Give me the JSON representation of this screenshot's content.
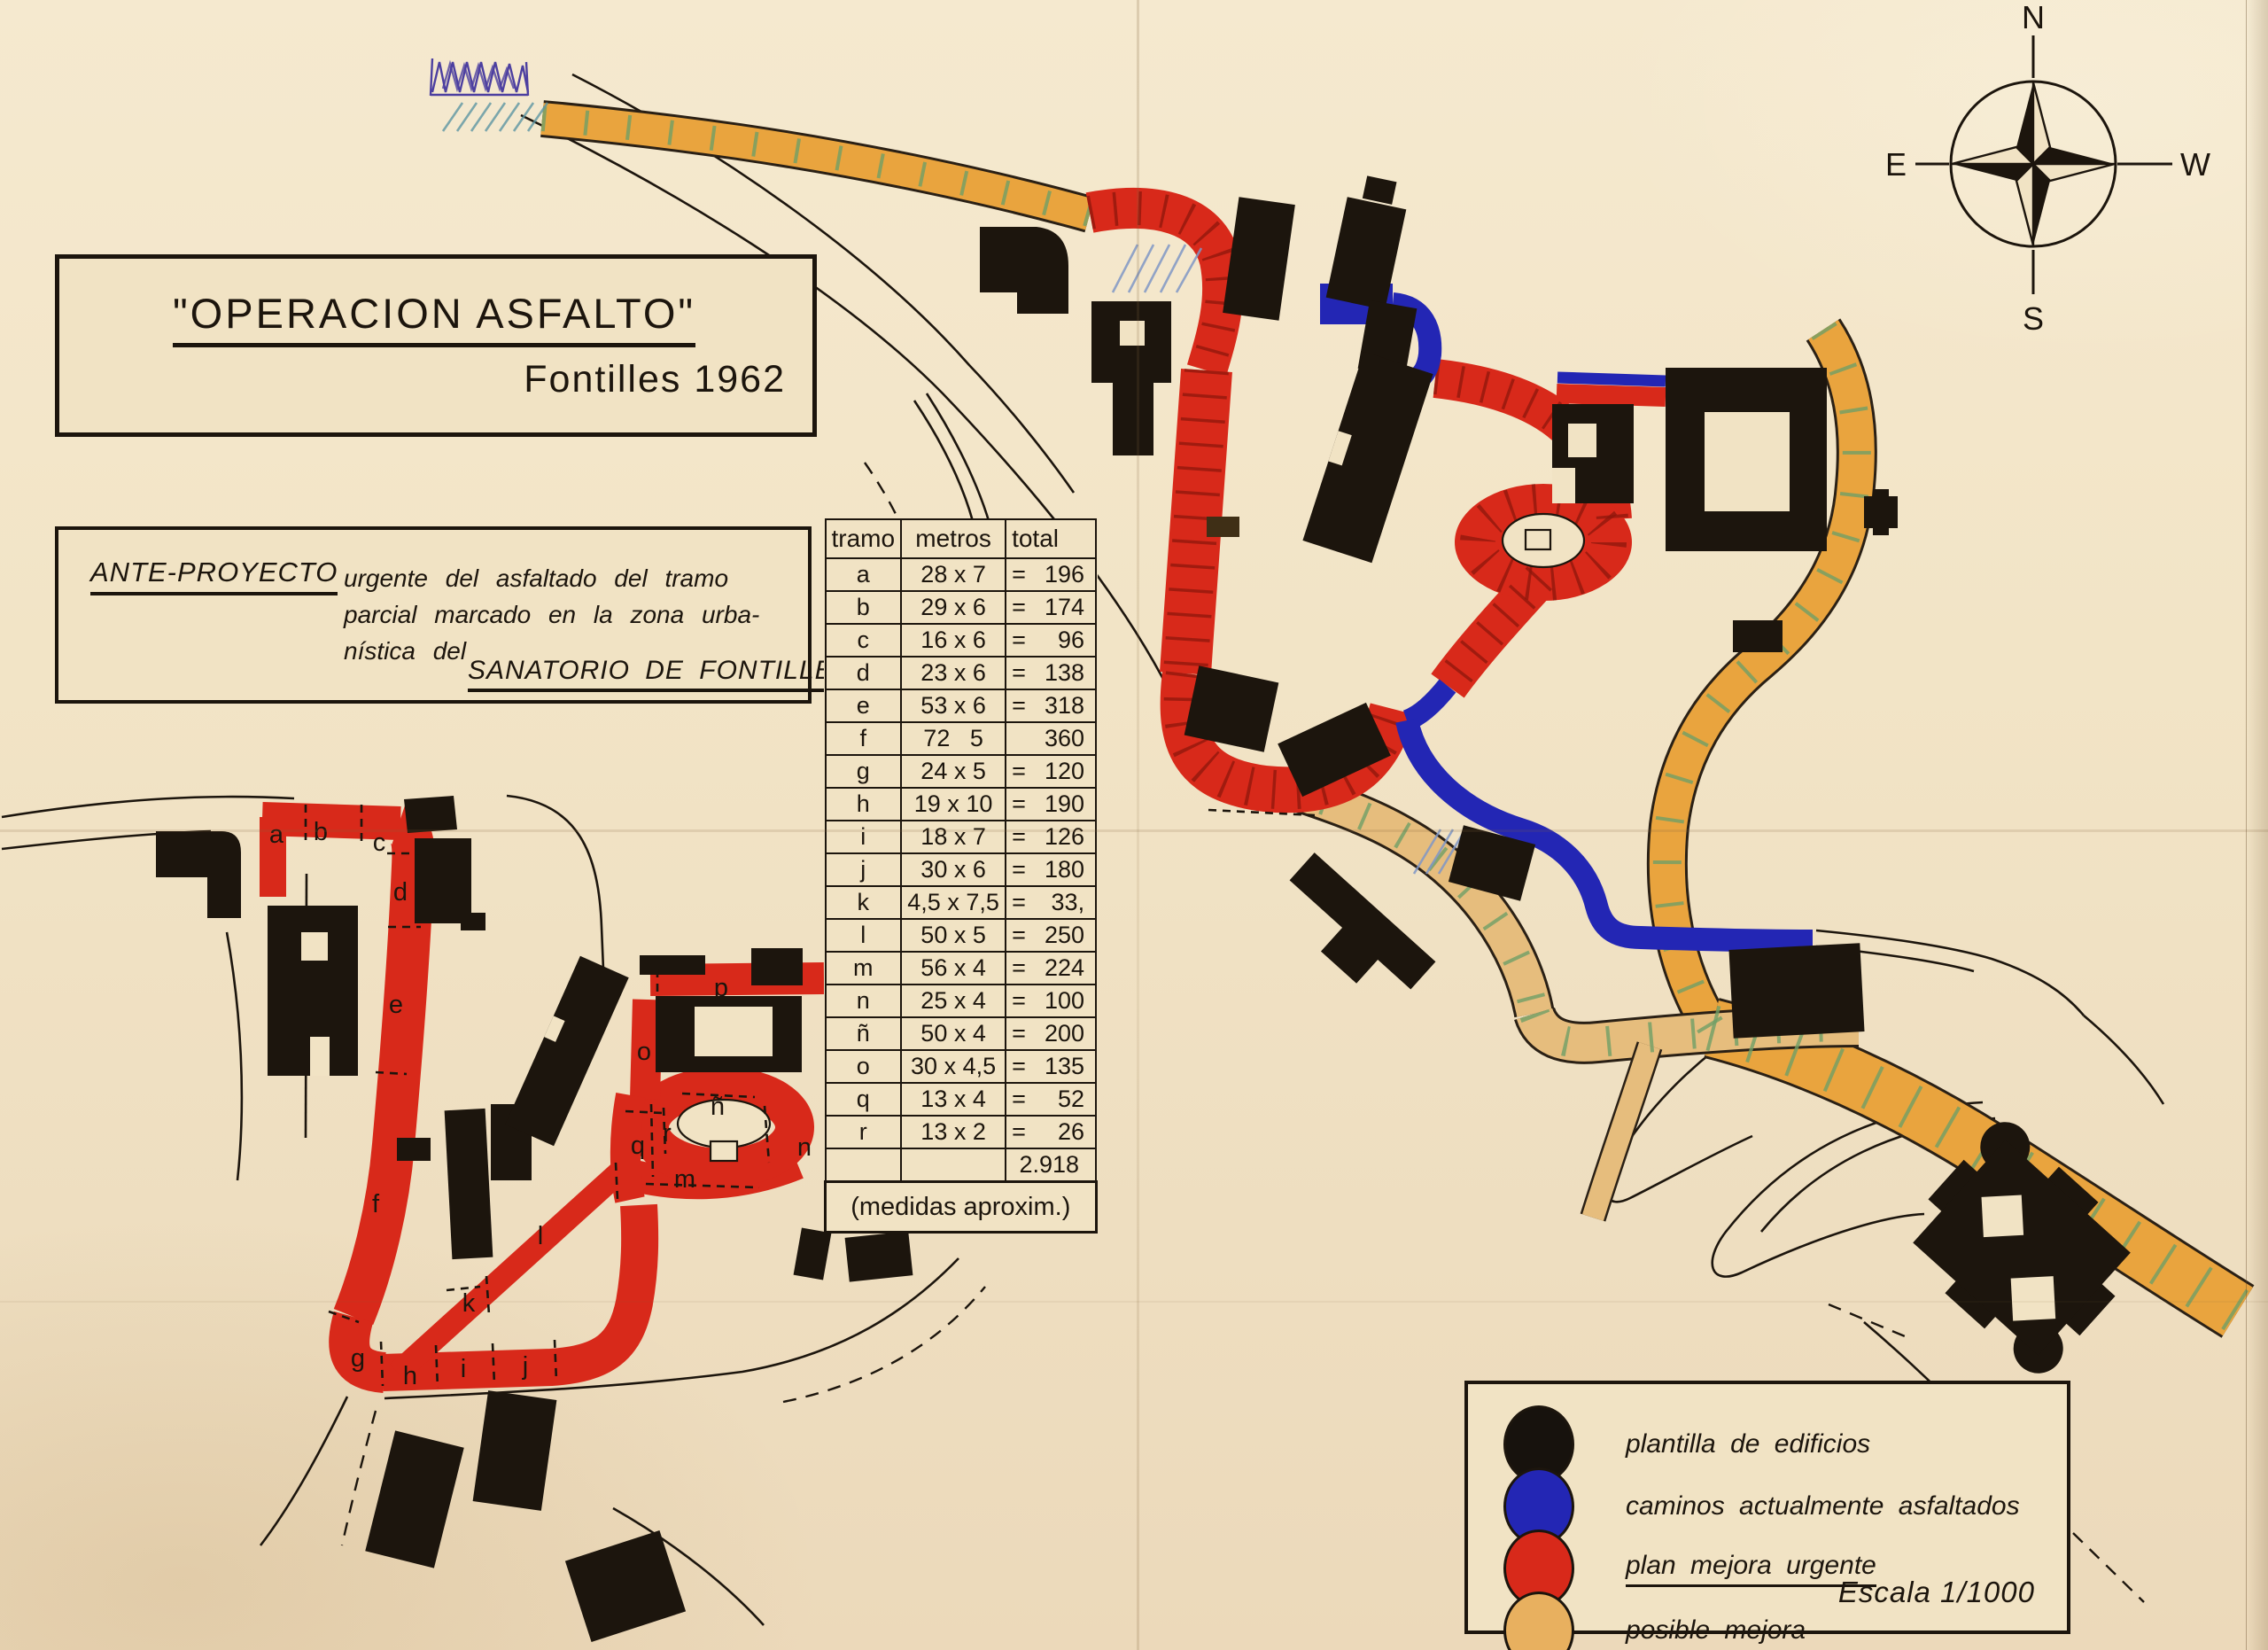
{
  "title_box": {
    "title": "\"OPERACION  ASFALTO\"",
    "subtitle": "Fontilles 1962"
  },
  "project_box": {
    "heading": "ANTE-PROYECTO",
    "line1": "urgente  del  asfaltado  del  tramo",
    "line2": "parcial   marcado  en  la  zona  urba-",
    "line3": "nística   del",
    "footer": "SANATORIO  DE  FONTILLES"
  },
  "measurements_table": {
    "headers": [
      "tramo",
      "metros",
      "total"
    ],
    "rows": [
      [
        "a",
        "28 x 7",
        "=",
        "196"
      ],
      [
        "b",
        "29 x 6",
        "=",
        "174"
      ],
      [
        "c",
        "16 x 6",
        "=",
        "96"
      ],
      [
        "d",
        "23 x 6",
        "=",
        "138"
      ],
      [
        "e",
        "53 x 6",
        "=",
        "318"
      ],
      [
        "f",
        "72   5",
        "",
        "360"
      ],
      [
        "g",
        "24 x 5",
        "=",
        "120"
      ],
      [
        "h",
        "19 x 10",
        "=",
        "190"
      ],
      [
        "i",
        "18 x 7",
        "=",
        "126"
      ],
      [
        "j",
        "30 x 6",
        "=",
        "180"
      ],
      [
        "k",
        "4,5 x 7,5",
        "=",
        "33,"
      ],
      [
        "l",
        "50 x 5",
        "=",
        "250"
      ],
      [
        "m",
        "56 x 4",
        "=",
        "224"
      ],
      [
        "n",
        "25 x 4",
        "=",
        "100"
      ],
      [
        "ñ",
        "50 x 4",
        "=",
        "200"
      ],
      [
        "o",
        "30 x 4,5",
        "=",
        "135"
      ],
      [
        "q",
        "13 x 4",
        "=",
        "52"
      ],
      [
        "r",
        "13 x 2",
        "=",
        "26"
      ]
    ],
    "total": "2.918",
    "note": "(medidas aproxim.)"
  },
  "legend": {
    "items": [
      {
        "name": "plantilla  de  edificios",
        "color": "#17120d",
        "underline": false
      },
      {
        "name": "caminos  actualmente  asfaltados",
        "color": "#2326b4",
        "underline": false
      },
      {
        "name": "plan  mejora  urgente",
        "color": "#d8291a",
        "underline": true
      },
      {
        "name": "posible  mejora",
        "color": "#e8b05f",
        "underline": false
      }
    ],
    "scale": "Escala  1/1000"
  },
  "compass": {
    "north": "N",
    "south": "S",
    "east": "E",
    "west": "W"
  },
  "map": {
    "segment_labels": [
      "a",
      "b",
      "c",
      "d",
      "e",
      "f",
      "g",
      "h",
      "i",
      "j",
      "k",
      "l",
      "m",
      "n",
      "ñ",
      "o",
      "p",
      "q",
      "r"
    ]
  },
  "colors": {
    "paper": "#f1e3c4",
    "ink": "#1c150d",
    "red": "#d8291a",
    "blue": "#2326b4",
    "orange": "#e9a43e",
    "tan": "#e6bd7d",
    "green_tick": "#6f9f67",
    "hatch_red": "#8e170c",
    "pencil_blue": "#7f96c6",
    "pencil_teal": "#5d95a2",
    "pencil_purple": "#4c3fa0"
  }
}
